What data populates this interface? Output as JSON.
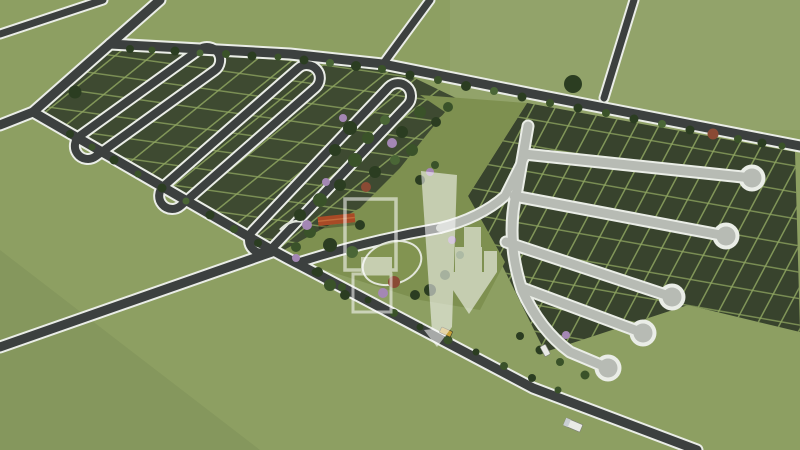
{
  "meta": {
    "image_type": "aerial 3D architectural visualization",
    "subject": "residential land subdivision master plan surrounded by open fields",
    "text_on_screen": "none"
  },
  "colors": {
    "field": "#8d9f62",
    "lotsLeft": "#3e4a31",
    "lotsRight": "#38432d",
    "lotLine": "#8da45f",
    "roadDark": "#3c403f",
    "roadLight": "#b7bbb4",
    "roadEdge": "#eaede7",
    "parkGreen": "#7e9050",
    "lawn": "#85975299",
    "treeDark": "#2b3d21",
    "treeMid": "#3a5229",
    "treeLight": "#4a6636",
    "treePurple": "#a487b4",
    "treeRed": "#8a4a34",
    "roof": "#a84a26",
    "watermark": "#ffffff",
    "watermarkOpacity": "0.55",
    "vehicleYellow": "#c8a23a",
    "vehicleWhite": "#e9eae6"
  },
  "scene": {
    "left_sector": {
      "style": "dark asphalt hairpin loop streets inside gridded lots",
      "loop_streets": 3
    },
    "right_sector": {
      "style": "light concrete streets ending in lollipop cul-de-sacs",
      "cul_de_sac_bulbs": 5
    },
    "park": {
      "features": [
        "circular lawn roundabout",
        "clubhouse with orange roof",
        "dense tree cluster",
        "flowering purple trees",
        "white footpaths"
      ]
    },
    "roads": {
      "main_network": "white-edged asphalt roads crossing the fields with a four-way junction at left and two branch roads exiting the top edge",
      "tree_lined_boundaries": 2
    },
    "vehicles": [
      {
        "type": "car",
        "color": "yellow",
        "location": "lower diagonal road"
      },
      {
        "type": "truck",
        "color": "white",
        "location": "bottom-right road"
      },
      {
        "type": "car",
        "color": "white",
        "location": "right sector spine road"
      }
    ],
    "watermark": {
      "style": "large translucent white real-estate logo overlaid at center",
      "elements": [
        "outlined block",
        "tall tower slab",
        "stepped building bars",
        "downward arrow"
      ]
    }
  }
}
